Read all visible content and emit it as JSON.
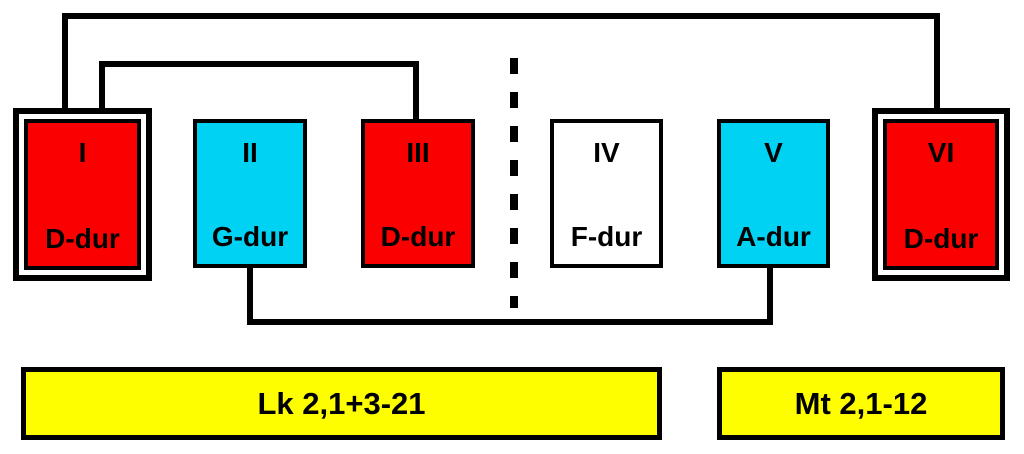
{
  "diagram": {
    "boxes": [
      {
        "numeral": "I",
        "key": "D-dur",
        "color": "#fa0000",
        "framed": true
      },
      {
        "numeral": "II",
        "key": "G-dur",
        "color": "#00d2f3",
        "framed": false
      },
      {
        "numeral": "III",
        "key": "D-dur",
        "color": "#fa0000",
        "framed": false
      },
      {
        "numeral": "IV",
        "key": "F-dur",
        "color": "#ffffff",
        "framed": false
      },
      {
        "numeral": "V",
        "key": "A-dur",
        "color": "#00d2f3",
        "framed": false
      },
      {
        "numeral": "VI",
        "key": "D-dur",
        "color": "#fa0000",
        "framed": true
      }
    ],
    "connections": [
      {
        "from": "I",
        "to": "VI",
        "path": "top-outer"
      },
      {
        "from": "I",
        "to": "III",
        "path": "top-inner"
      },
      {
        "from": "II",
        "to": "V",
        "path": "bottom"
      }
    ],
    "divider": {
      "style": "dashed",
      "between": "III and IV"
    },
    "labels": [
      {
        "text": "Lk 2,1+3-21",
        "color": "#fefe00"
      },
      {
        "text": "Mt 2,1-12",
        "color": "#fefe00"
      }
    ],
    "line_color": "#000000",
    "background_color": "#ffffff"
  }
}
